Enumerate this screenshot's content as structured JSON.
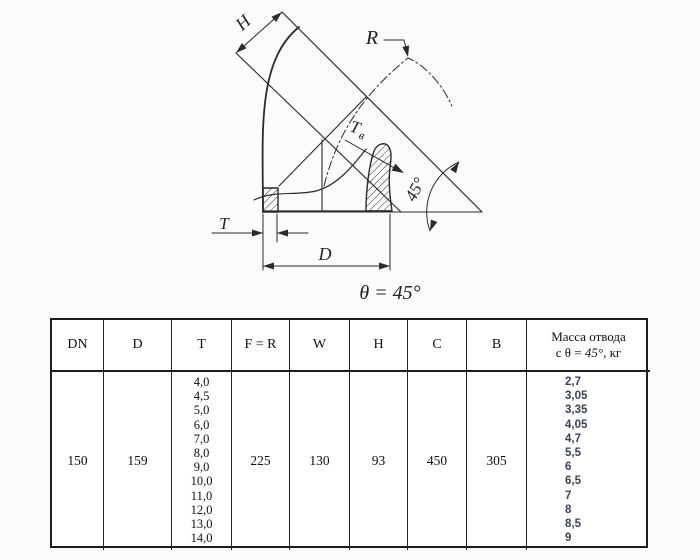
{
  "drawing": {
    "labels": {
      "h": "H",
      "r": "R",
      "t": "T",
      "d": "D",
      "t_wall_main": "T",
      "t_wall_sub": "в",
      "angle": "45°",
      "caption": "θ = 45°"
    }
  },
  "table": {
    "headers": [
      "DN",
      "D",
      "T",
      "F = R",
      "W",
      "H",
      "C",
      "B"
    ],
    "mass_header": {
      "line1": "Масса отвода",
      "line2_pre": "с θ = ",
      "line2_angle": "45°",
      "line2_post": ", кг"
    },
    "row": {
      "dn": "150",
      "d": "159",
      "t_values": [
        "4,0",
        "4,5",
        "5,0",
        "6,0",
        "7,0",
        "8,0",
        "9,0",
        "10,0",
        "11,0",
        "12,0",
        "13,0",
        "14,0"
      ],
      "f_r": "225",
      "w": "130",
      "h": "93",
      "c": "450",
      "b": "305",
      "mass_values": [
        "2,7",
        "3,05",
        "3,35",
        "4,05",
        "4,7",
        "5,5",
        "6",
        "6,5",
        "7",
        "8",
        "8,5",
        "9"
      ]
    }
  },
  "colors": {
    "line": "#2b2b2b",
    "mass_text": "#3c4254"
  }
}
